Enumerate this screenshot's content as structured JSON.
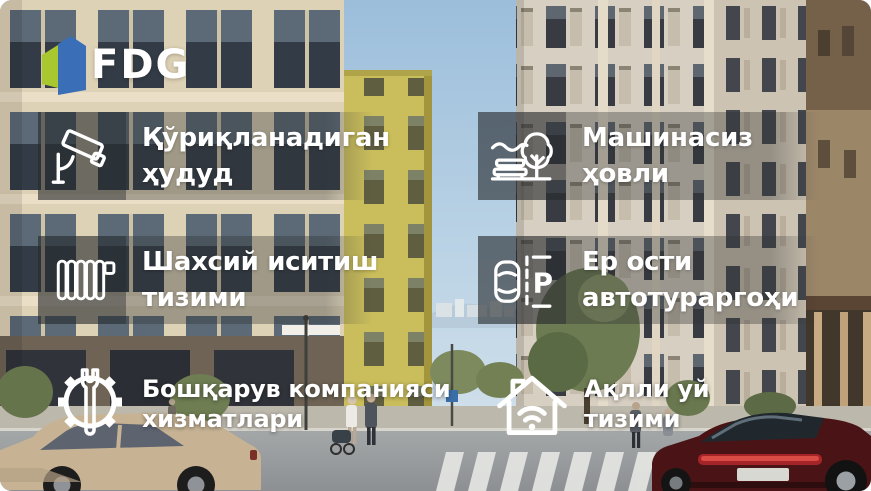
{
  "brand": {
    "name": "FDG",
    "logo_green": "#a9c72f",
    "logo_blue": "#3a6fb7"
  },
  "colors": {
    "feature_text": "#ffffff",
    "overlay_band": "rgba(44,46,47,0.35)",
    "icon_square": "rgba(36,41,46,0.42)",
    "sky": "#a9c6de"
  },
  "features": [
    {
      "id": "guarded-area",
      "icon": "cctv-camera-icon",
      "line1": "Қўриқланадиган",
      "line2": "ҳудуд"
    },
    {
      "id": "car-free-yard",
      "icon": "bench-tree-icon",
      "line1": "Машинасиз",
      "line2": "ҳовли"
    },
    {
      "id": "personal-heating",
      "icon": "radiator-icon",
      "line1": "Шахсий иситиш",
      "line2": "тизими"
    },
    {
      "id": "underground-parking",
      "icon": "parking-icon",
      "line1": "Ер ости",
      "line2": "автотураргоҳи"
    },
    {
      "id": "management-services",
      "icon": "gear-wrench-icon",
      "line1": "Бошқарув компанияси",
      "line2": "хизматлари"
    },
    {
      "id": "smart-home",
      "icon": "smart-home-icon",
      "line1": "Ақлли уй",
      "line2": "тизими"
    }
  ],
  "parking_icon_letter": "P"
}
